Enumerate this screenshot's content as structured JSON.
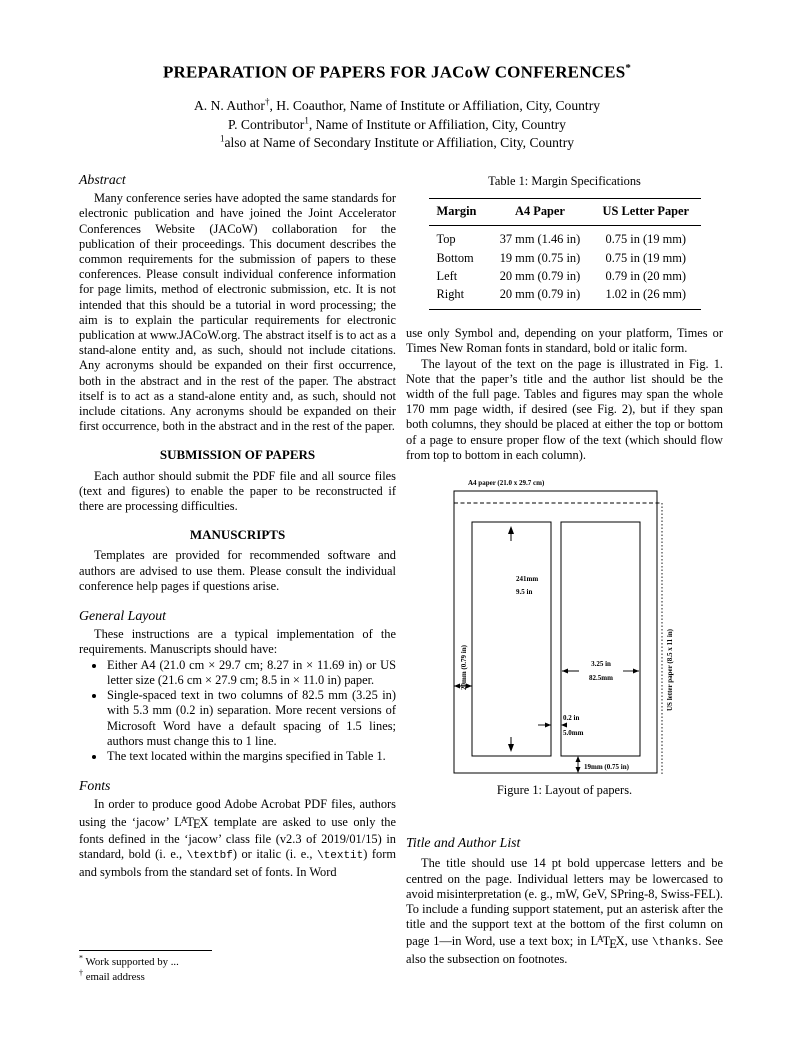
{
  "page": {
    "title": "PREPARATION OF PAPERS FOR JACoW CONFERENCES",
    "title_mark": "*",
    "author_line1": {
      "pre": "A. N. Author",
      "sup": "†",
      "post": ", H. Coauthor, Name of Institute or Affiliation, City, Country"
    },
    "author_line2": {
      "pre": "P. Contributor",
      "sup": "1",
      "post": ", Name of Institute or Affiliation, City, Country"
    },
    "author_line3": {
      "sup": "1",
      "post": "also at Name of Secondary Institute or Affiliation, City, Country"
    }
  },
  "latex_logo": {
    "l": "L",
    "a": "A",
    "t": "T",
    "e": "E",
    "x": "X"
  },
  "left_column": {
    "abstract_heading": "Abstract",
    "abstract_text": "Many conference series have adopted the same standards for electronic publication and have joined the Joint Accelerator Conferences Website (JACoW) collaboration for the publication of their proceedings. This document describes the common requirements for the submission of papers to these conferences. Please consult individual conference information for page limits, method of electronic submission, etc. It is not intended that this should be a tutorial in word processing; the aim is to explain the particular requirements for electronic publication at www.JACoW.org. The abstract itself is to act as a stand-alone entity and, as such, should not include citations. Any acronyms should be expanded on their first occurrence, both in the abstract and in the rest of the paper. The abstract itself is to act as a stand-alone entity and, as such, should not include citations. Any acronyms should be expanded on their first occurrence, both in the abstract and in the rest of the paper.",
    "submission_heading": "SUBMISSION OF PAPERS",
    "submission_text": "Each author should submit the PDF file and all source files (text and figures) to enable the paper to be reconstructed if there are processing difficulties.",
    "manuscripts_heading": "MANUSCRIPTS",
    "manuscripts_text": "Templates are provided for recommended software and authors are advised to use them. Please consult the individual conference help pages if questions arise.",
    "general_layout_heading": "General Layout",
    "general_layout_intro": "These instructions are a typical implementation of the requirements. Manuscripts should have:",
    "bullets": [
      "Either A4 (21.0 cm × 29.7 cm; 8.27 in × 11.69 in) or US letter size (21.6 cm × 27.9 cm; 8.5 in × 11.0 in) paper.",
      "Single-spaced text in two columns of 82.5 mm (3.25 in) with 5.3 mm (0.2 in) separation. More recent versions of Microsoft Word have a default spacing of 1.5 lines; authors must change this to 1 line.",
      "The text located within the margins specified in Table 1."
    ],
    "fonts_heading": "Fonts",
    "fonts": {
      "seg1": "In order to produce good Adobe Acrobat PDF files, authors using the ‘jacow’ ",
      "seg2": " template are asked to use only the fonts defined in the ‘jacow’ class file (v2.3 of 2019/01/15) in standard, bold (i. e., ",
      "code1": "\\textbf",
      "seg3": ") or italic (i. e., ",
      "code2": "\\textit",
      "seg4": ") form and symbols from the standard set of fonts. In Word"
    }
  },
  "right_column": {
    "table": {
      "caption": "Table 1: Margin Specifications",
      "headers": [
        "Margin",
        "A4 Paper",
        "US Letter Paper"
      ],
      "rows": [
        [
          "Top",
          "37 mm (1.46 in)",
          "0.75 in (19 mm)"
        ],
        [
          "Bottom",
          "19 mm (0.75 in)",
          "0.75 in (19 mm)"
        ],
        [
          "Left",
          "20 mm (0.79 in)",
          "0.79 in (20 mm)"
        ],
        [
          "Right",
          "20 mm (0.79 in)",
          "1.02 in (26 mm)"
        ]
      ]
    },
    "para1": "use only Symbol and, depending on your platform, Times or Times New Roman fonts in standard, bold or italic form.",
    "para2": "The layout of the text on the page is illustrated in Fig. 1. Note that the paper’s title and the author list should be the width of the full page. Tables and figures may span the whole 170 mm page width, if desired (see Fig. 2), but if they span both columns, they should be placed at either the top or bottom of a page to ensure proper flow of the text (which should flow from top to bottom in each column).",
    "title_author_heading": "Title and Author List",
    "title_author": {
      "seg1": "The title should use 14 pt bold uppercase letters and be centred on the page. Individual letters may be lowercased to avoid misinterpretation (e. g., mW, GeV, SPring-8, Swiss-FEL). To include a funding support statement, put an asterisk after the title and the support text at the bottom of the first column on page 1—in Word, use a text box; in ",
      "seg2": ", use ",
      "code1": "\\thanks",
      "seg3": ". See also the subsection on footnotes."
    }
  },
  "figure": {
    "a4_label": "A4 paper (21.0 x 29.7 cm)",
    "col_height_mm": "241mm",
    "col_height_in": "9.5 in",
    "left_margin": "20mm (0.79 in)",
    "us_letter": "US letter paper (8.5 x 11 in)",
    "col_width_in": "3.25 in",
    "col_width_mm": "82.5mm",
    "gap_in": "0.2 in",
    "gap_mm": "5.0mm",
    "bottom_margin": "19mm (0.75 in)",
    "caption": "Figure 1: Layout of papers."
  },
  "footnotes": {
    "mark1": "*",
    "text1": "Work supported by ...",
    "mark2": "†",
    "text2": "email address"
  }
}
